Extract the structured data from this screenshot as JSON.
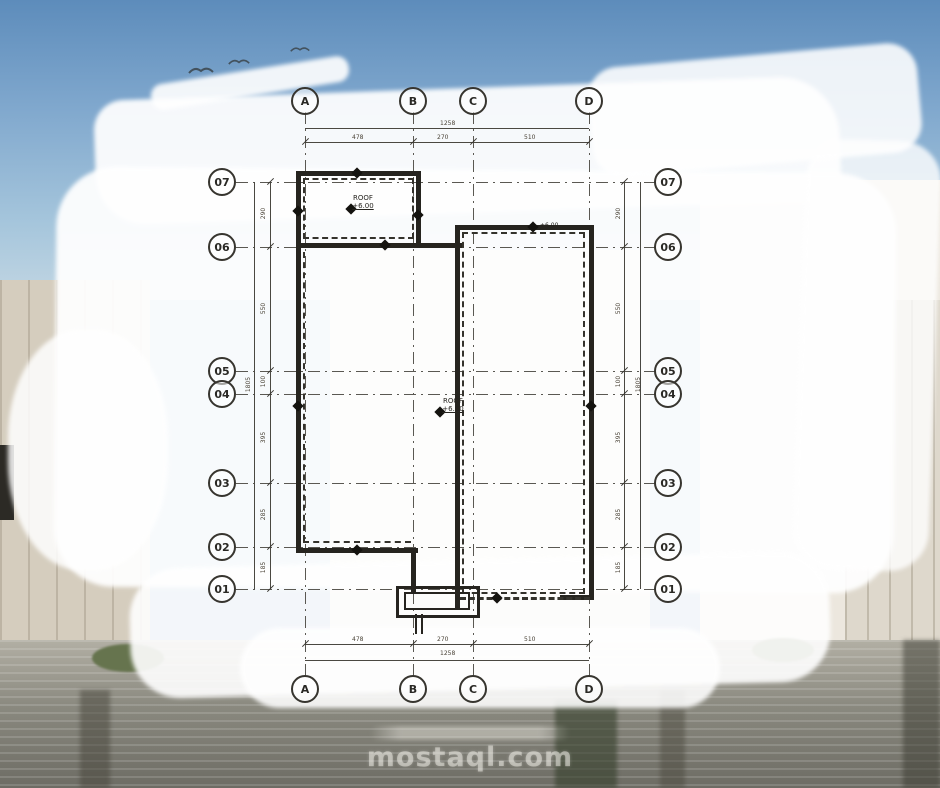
{
  "grid_bubbles": {
    "top": [
      "A",
      "B",
      "C",
      "D"
    ],
    "bottom": [
      "A",
      "B",
      "C",
      "D"
    ],
    "left": [
      "07",
      "06",
      "05",
      "04",
      "03",
      "02",
      "01"
    ],
    "right": [
      "07",
      "06",
      "05",
      "04",
      "03",
      "02",
      "01"
    ]
  },
  "dimensions": {
    "top": {
      "overall": "1258",
      "segments": [
        "478",
        "270",
        "510"
      ]
    },
    "bottom": {
      "overall": "1258",
      "segments": [
        "478",
        "270",
        "510"
      ]
    },
    "left": {
      "overall": "1805",
      "segments": [
        "290",
        "550",
        "100",
        "395",
        "285",
        "185"
      ]
    },
    "right": {
      "overall": "1805",
      "segments": [
        "290",
        "550",
        "100",
        "395",
        "285",
        "185"
      ]
    }
  },
  "labels": {
    "roof_upper": {
      "name": "ROOF",
      "level": "+6.00"
    },
    "roof_main": {
      "name": "ROOF",
      "level": "+6.00"
    },
    "level_marker_right": "+6.00"
  },
  "watermark": {
    "site": "mostaql.com"
  },
  "icons": [
    "bird-icon",
    "level-marker-icon"
  ],
  "colors": {
    "sky": "#5d8cbb",
    "wash": "#ffffff",
    "plan_line": "#26241f",
    "ground": "#6d6c64"
  }
}
